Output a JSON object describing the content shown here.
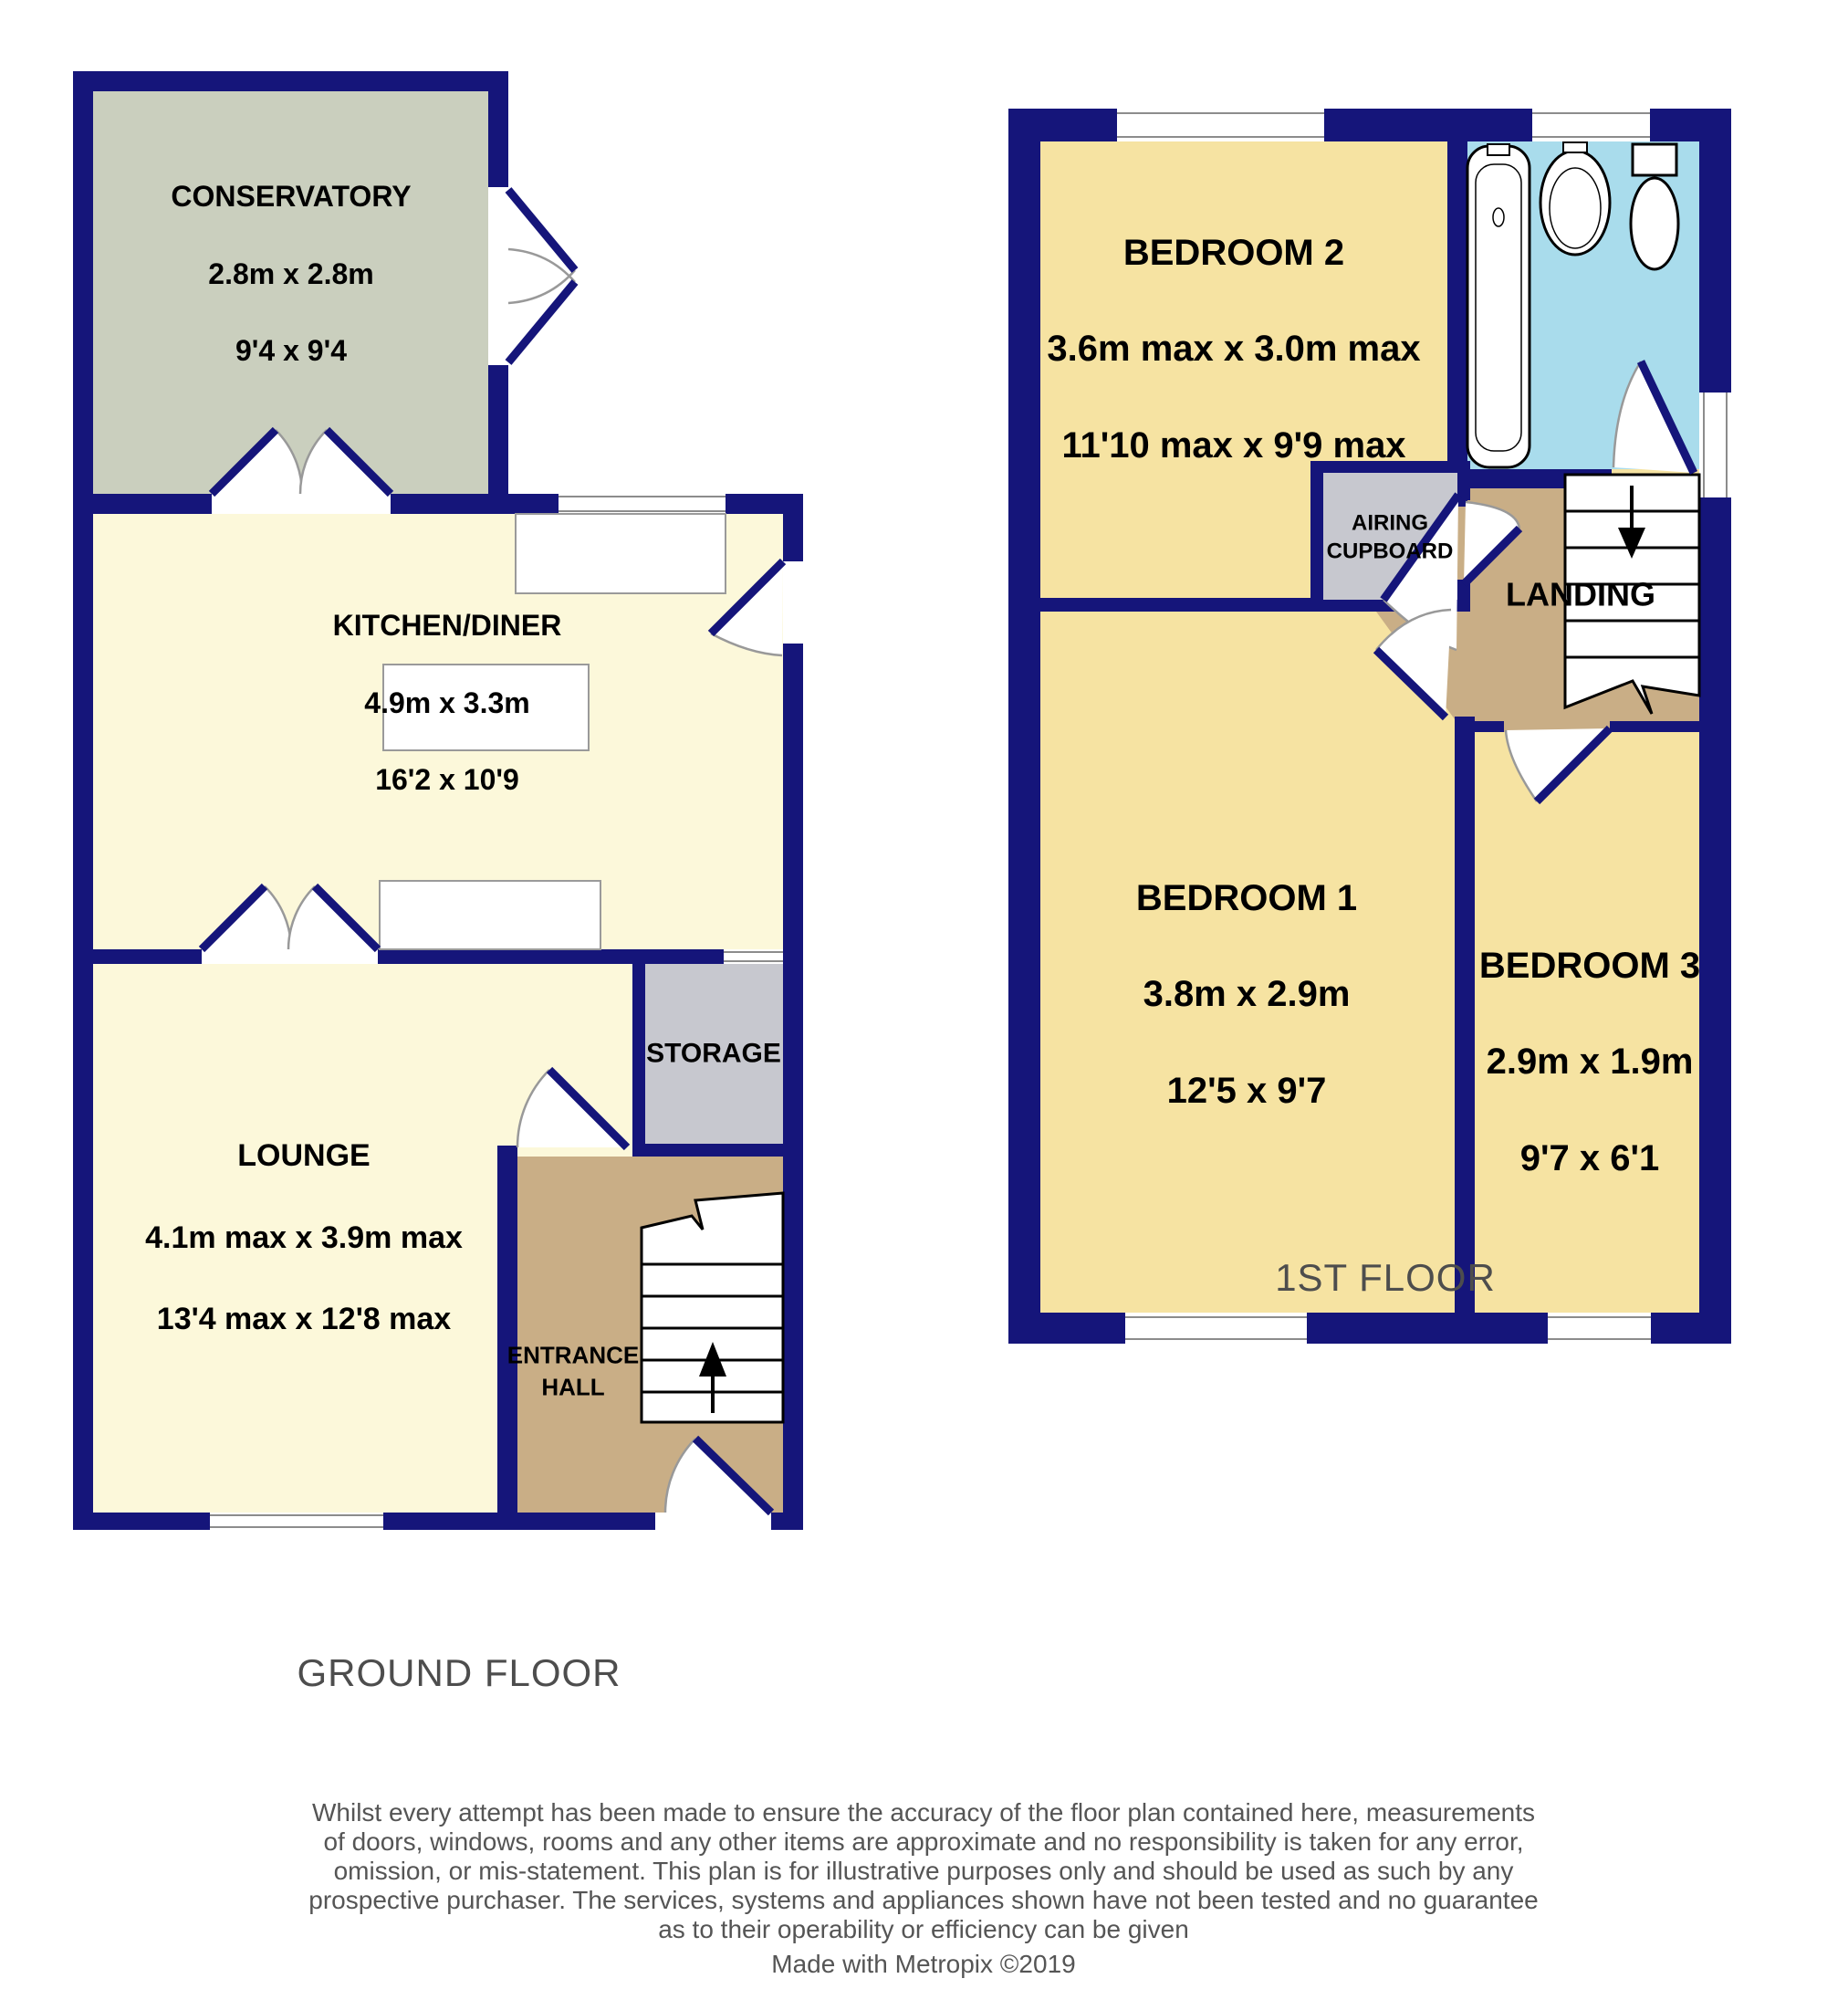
{
  "page": {
    "background": "#ffffff"
  },
  "colors": {
    "wall": "#15157a",
    "kitchen_floor": "#fcf8da",
    "conservatory_floor": "#cacfbe",
    "hall_floor": "#c9ae86",
    "storage_floor": "#c7c8cf",
    "bedroom_floor": "#f6e3a2",
    "bathroom_floor": "#a9dcec",
    "door_arc": "#999999",
    "label_text": "#000000",
    "muted_text": "#555555"
  },
  "ground_floor": {
    "title": "GROUND FLOOR",
    "rooms": {
      "conservatory": {
        "name": "CONSERVATORY",
        "dim_metric": "2.8m x 2.8m",
        "dim_imperial": "9'4 x 9'4"
      },
      "kitchen_diner": {
        "name": "KITCHEN/DINER",
        "dim_metric": "4.9m x 3.3m",
        "dim_imperial": "16'2 x 10'9"
      },
      "lounge": {
        "name": "LOUNGE",
        "dim_metric": "4.1m max x 3.9m max",
        "dim_imperial": "13'4 max x 12'8 max"
      },
      "storage": {
        "name": "STORAGE"
      },
      "entrance_hall": {
        "name": "ENTRANCE\nHALL"
      }
    }
  },
  "first_floor": {
    "title": "1ST FLOOR",
    "rooms": {
      "bedroom_2": {
        "name": "BEDROOM 2",
        "dim_metric": "3.6m max x 3.0m max",
        "dim_imperial": "11'10 max x 9'9 max"
      },
      "bedroom_1": {
        "name": "BEDROOM 1",
        "dim_metric": "3.8m x 2.9m",
        "dim_imperial": "12'5 x 9'7"
      },
      "bedroom_3": {
        "name": "BEDROOM 3",
        "dim_metric": "2.9m x 1.9m",
        "dim_imperial": "9'7 x 6'1"
      },
      "landing": {
        "name": "LANDING"
      },
      "airing_cupboard": {
        "name": "AIRING\nCUPBOARD"
      }
    }
  },
  "footer": {
    "disclaimer": "Whilst every attempt has been made to ensure the accuracy of the floor plan contained here, measurements\nof doors, windows, rooms and any other items are approximate and no responsibility is taken for any error,\nomission, or mis-statement. This plan is for illustrative purposes only and should be used as such by any\nprospective purchaser. The services, systems and appliances shown have not been tested and no guarantee\nas to their operability or efficiency can be given",
    "credit": "Made with Metropix ©2019"
  }
}
